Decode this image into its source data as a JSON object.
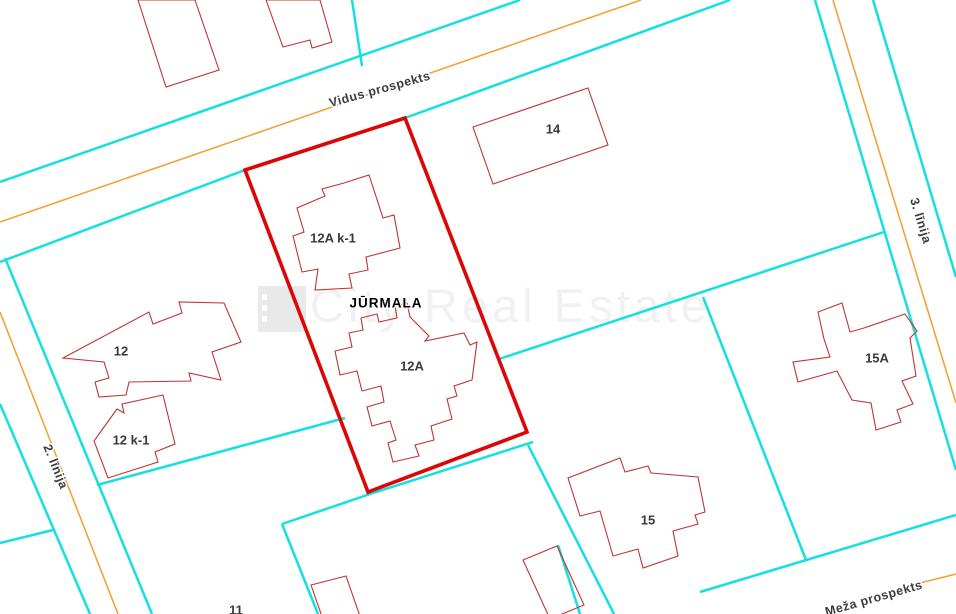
{
  "map": {
    "width": 956,
    "height": 614,
    "region_label": {
      "text": "JŪRMALA",
      "pos": [
        386,
        304
      ]
    },
    "watermark": {
      "text": "City Real Estate",
      "pos": [
        310,
        322
      ],
      "logo": {
        "x": 258,
        "y": 286,
        "w": 48,
        "h": 46,
        "dots": [
          294,
          305,
          316
        ]
      }
    },
    "colors": {
      "background": "#ffffff",
      "street_edge": "#16dfe2",
      "street_center": "#efa43b",
      "building_outline": "#c03434",
      "selected_parcel": "#dd0606",
      "street_label": "#3c3c3c",
      "building_label": "#3a3a3a",
      "region_label": "#000000",
      "watermark_text": "#f1f1f1",
      "watermark_logo": "#e9e9e9"
    },
    "streets": [
      {
        "id": "street-label-vidus-prospekts",
        "name": "Vidus prospekts",
        "label_pos": [
          380,
          90
        ],
        "rotation": -15.5
      },
      {
        "id": "street-label-2-linija",
        "name": "2. līnija",
        "label_pos": [
          55,
          467
        ],
        "rotation": 68
      },
      {
        "id": "street-label-3-linija",
        "name": "3. līnija",
        "label_pos": [
          920,
          221
        ],
        "rotation": 73
      },
      {
        "id": "street-label-meza-prospekts",
        "name": "Meža prospekts",
        "label_pos": [
          874,
          599
        ],
        "rotation": -16
      }
    ],
    "selected_parcel": {
      "id": "selected-parcel-outline",
      "points": [
        [
          245,
          170
        ],
        [
          405,
          118
        ],
        [
          527,
          432
        ],
        [
          368,
          492
        ]
      ]
    },
    "buildings": [
      {
        "id": "building-top-left-a",
        "label": "",
        "points": [
          [
            138,
            0
          ],
          [
            166,
            87
          ],
          [
            219,
            70
          ],
          [
            195,
            0
          ]
        ]
      },
      {
        "id": "building-top-left-b",
        "label": "",
        "points": [
          [
            266,
            0
          ],
          [
            283,
            47
          ],
          [
            310,
            40
          ],
          [
            312,
            48
          ],
          [
            332,
            42
          ],
          [
            320,
            0
          ]
        ]
      },
      {
        "id": "building-14",
        "label": "14",
        "label_pos": [
          553,
          130
        ],
        "points": [
          [
            473,
            127
          ],
          [
            588,
            88
          ],
          [
            608,
            145
          ],
          [
            493,
            184
          ]
        ]
      },
      {
        "id": "building-12a-k1",
        "label": "12A k-1",
        "label_pos": [
          333,
          239
        ],
        "points": [
          [
            369,
            175
          ],
          [
            383,
            218
          ],
          [
            394,
            215
          ],
          [
            400,
            248
          ],
          [
            366,
            257
          ],
          [
            368,
            270
          ],
          [
            349,
            274
          ],
          [
            352,
            288
          ],
          [
            315,
            290
          ],
          [
            318,
            269
          ],
          [
            302,
            272
          ],
          [
            293,
            236
          ],
          [
            304,
            232
          ],
          [
            297,
            208
          ],
          [
            325,
            196
          ],
          [
            322,
            189
          ],
          [
            344,
            183
          ]
        ]
      },
      {
        "id": "building-12a",
        "label": "12A",
        "label_pos": [
          412,
          367
        ],
        "points": [
          [
            395,
            306
          ],
          [
            407,
            303
          ],
          [
            410,
            317
          ],
          [
            429,
            336
          ],
          [
            425,
            341
          ],
          [
            464,
            333
          ],
          [
            470,
            345
          ],
          [
            477,
            342
          ],
          [
            472,
            380
          ],
          [
            454,
            386
          ],
          [
            457,
            396
          ],
          [
            447,
            399
          ],
          [
            452,
            419
          ],
          [
            431,
            426
          ],
          [
            434,
            440
          ],
          [
            415,
            445
          ],
          [
            419,
            456
          ],
          [
            393,
            462
          ],
          [
            388,
            443
          ],
          [
            396,
            440
          ],
          [
            390,
            421
          ],
          [
            372,
            426
          ],
          [
            367,
            407
          ],
          [
            384,
            402
          ],
          [
            381,
            386
          ],
          [
            362,
            391
          ],
          [
            357,
            371
          ],
          [
            340,
            375
          ],
          [
            335,
            351
          ],
          [
            352,
            347
          ],
          [
            349,
            333
          ],
          [
            363,
            330
          ],
          [
            361,
            318
          ],
          [
            377,
            314
          ],
          [
            379,
            322
          ],
          [
            397,
            318
          ]
        ]
      },
      {
        "id": "building-12",
        "label": "12",
        "label_pos": [
          121,
          352
        ],
        "points": [
          [
            63,
            358
          ],
          [
            149,
            312
          ],
          [
            153,
            324
          ],
          [
            182,
            313
          ],
          [
            179,
            302
          ],
          [
            224,
            303
          ],
          [
            241,
            342
          ],
          [
            212,
            352
          ],
          [
            221,
            380
          ],
          [
            189,
            373
          ],
          [
            191,
            381
          ],
          [
            129,
            382
          ],
          [
            126,
            395
          ],
          [
            99,
            397
          ],
          [
            95,
            382
          ],
          [
            109,
            378
          ],
          [
            104,
            362
          ]
        ]
      },
      {
        "id": "building-12-k1",
        "label": "12 k-1",
        "label_pos": [
          131,
          441
        ],
        "points": [
          [
            94,
            441
          ],
          [
            117,
            409
          ],
          [
            124,
            413
          ],
          [
            122,
            404
          ],
          [
            163,
            395
          ],
          [
            175,
            444
          ],
          [
            155,
            452
          ],
          [
            158,
            462
          ],
          [
            108,
            478
          ]
        ]
      },
      {
        "id": "building-15",
        "label": "15",
        "label_pos": [
          648,
          521
        ],
        "points": [
          [
            620,
            458
          ],
          [
            625,
            472
          ],
          [
            648,
            466
          ],
          [
            651,
            473
          ],
          [
            698,
            477
          ],
          [
            705,
            512
          ],
          [
            695,
            515
          ],
          [
            698,
            524
          ],
          [
            673,
            531
          ],
          [
            678,
            556
          ],
          [
            643,
            568
          ],
          [
            638,
            549
          ],
          [
            613,
            556
          ],
          [
            600,
            511
          ],
          [
            580,
            516
          ],
          [
            568,
            478
          ]
        ]
      },
      {
        "id": "building-15a",
        "label": "15A",
        "label_pos": [
          877,
          359
        ],
        "points": [
          [
            818,
            312
          ],
          [
            842,
            303
          ],
          [
            850,
            332
          ],
          [
            864,
            328
          ],
          [
            905,
            314
          ],
          [
            917,
            331
          ],
          [
            910,
            338
          ],
          [
            916,
            376
          ],
          [
            902,
            381
          ],
          [
            913,
            404
          ],
          [
            897,
            410
          ],
          [
            901,
            422
          ],
          [
            876,
            430
          ],
          [
            871,
            403
          ],
          [
            852,
            400
          ],
          [
            837,
            371
          ],
          [
            798,
            382
          ],
          [
            793,
            362
          ],
          [
            830,
            357
          ],
          [
            824,
            339
          ]
        ]
      },
      {
        "id": "building-11",
        "label": "11",
        "label_pos": [
          236,
          611
        ],
        "points": [
          [
            311,
            585
          ],
          [
            346,
            576
          ],
          [
            362,
            622
          ],
          [
            327,
            631
          ]
        ]
      },
      {
        "id": "building-bottom-right",
        "label": "",
        "points": [
          [
            523,
            560
          ],
          [
            557,
            546
          ],
          [
            584,
            605
          ],
          [
            550,
            619
          ]
        ]
      }
    ],
    "geometry": {
      "street_edges": [
        [
          [
            0,
            182
          ],
          [
            520,
            0
          ]
        ],
        [
          [
            0,
            262
          ],
          [
            245,
            170
          ]
        ],
        [
          [
            405,
            118
          ],
          [
            730,
            0
          ]
        ],
        [
          [
            352,
            0
          ],
          [
            362,
            66
          ]
        ],
        [
          [
            815,
            0
          ],
          [
            956,
            470
          ]
        ],
        [
          [
            873,
            0
          ],
          [
            956,
            277
          ]
        ],
        [
          [
            5,
            258
          ],
          [
            152,
            614
          ]
        ],
        [
          [
            0,
            404
          ],
          [
            90,
            614
          ]
        ],
        [
          [
            0,
            543
          ],
          [
            53,
            530
          ]
        ],
        [
          [
            97,
            485
          ],
          [
            345,
            418
          ]
        ],
        [
          [
            282,
            524
          ],
          [
            318,
            614
          ]
        ],
        [
          [
            282,
            524
          ],
          [
            373,
            493
          ],
          [
            533,
            442
          ]
        ],
        [
          [
            499,
            359
          ],
          [
            884,
            232
          ]
        ],
        [
          [
            703,
            297
          ],
          [
            806,
            560
          ]
        ],
        [
          [
            700,
            592
          ],
          [
            956,
            515
          ]
        ],
        [
          [
            528,
            445
          ],
          [
            614,
            614
          ]
        ],
        [
          [
            558,
            545
          ],
          [
            580,
            614
          ]
        ]
      ],
      "street_centerlines": [
        [
          [
            0,
            222
          ],
          [
            641,
            0
          ]
        ],
        [
          [
            0,
            312
          ],
          [
            118,
            614
          ]
        ],
        [
          [
            833,
            0
          ],
          [
            956,
            403
          ]
        ],
        [
          [
            908,
            586
          ],
          [
            956,
            574
          ]
        ]
      ]
    }
  }
}
